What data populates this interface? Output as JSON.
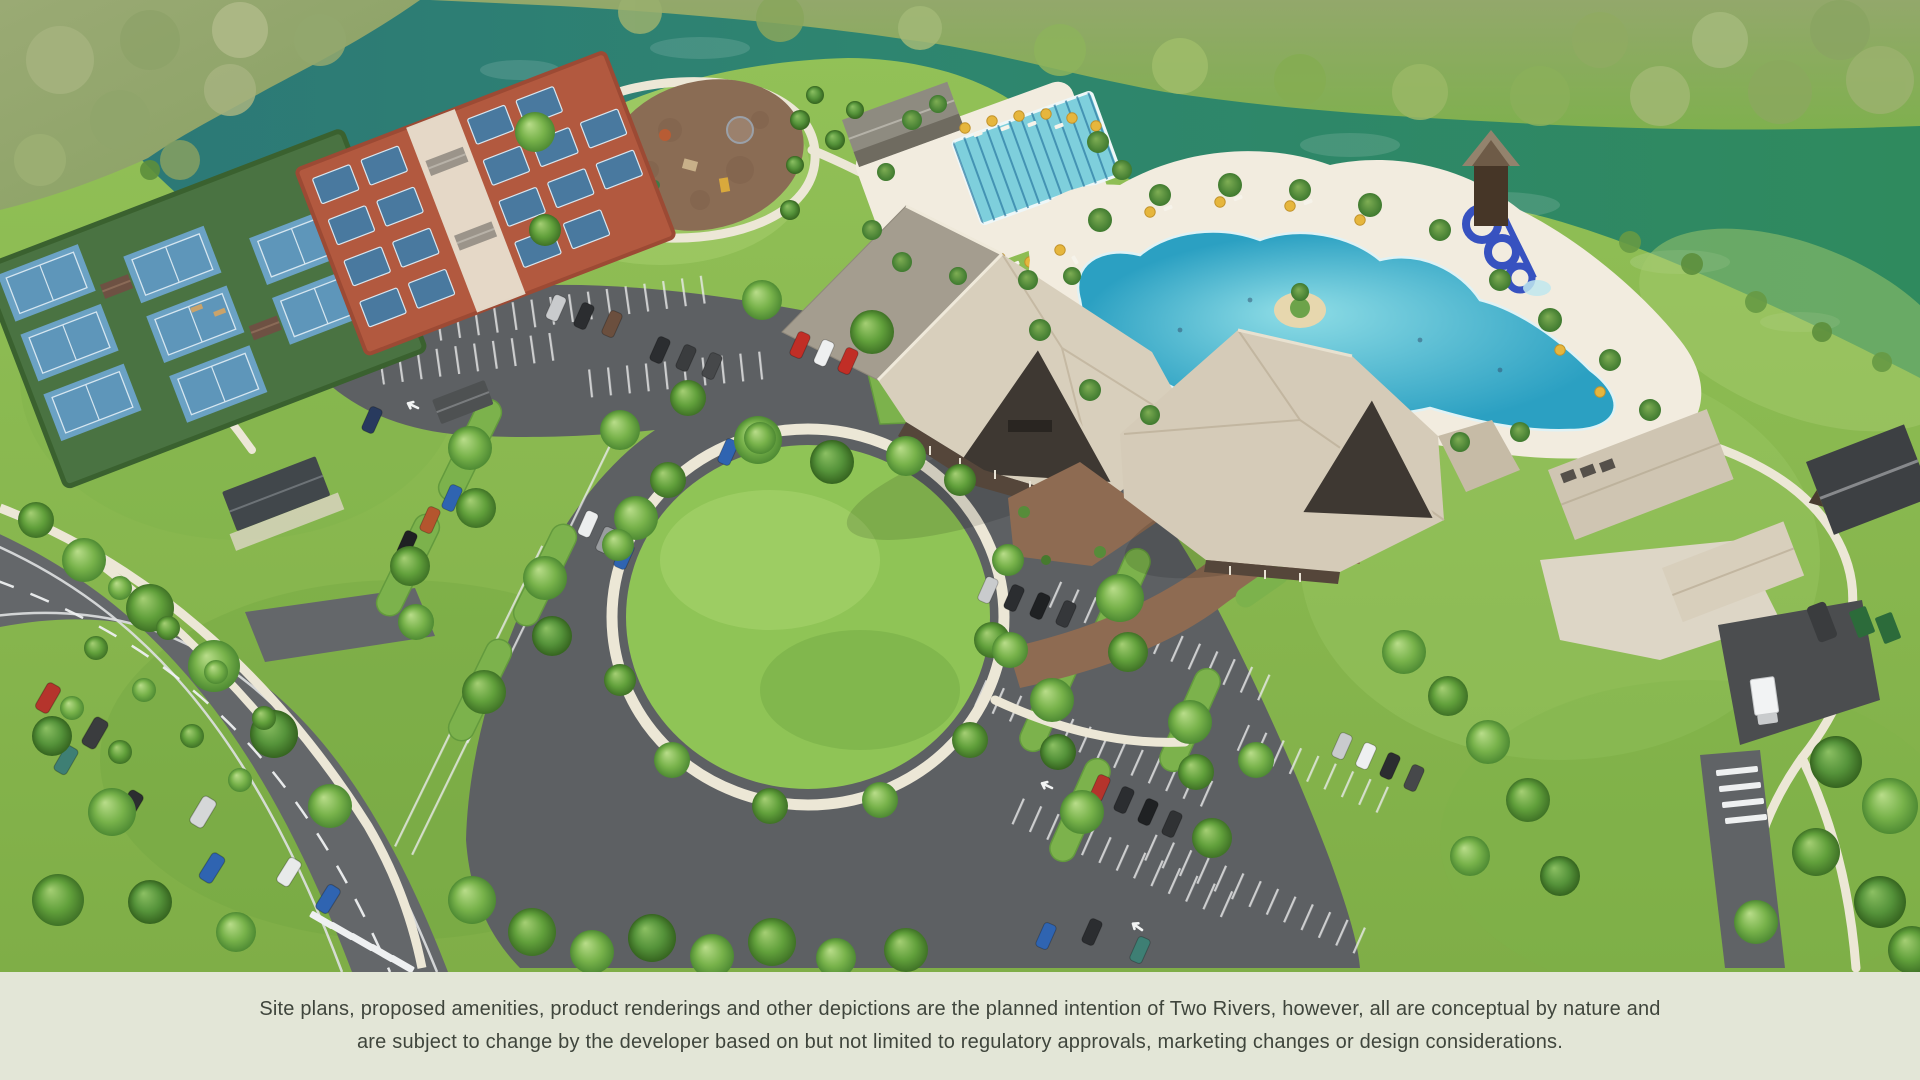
{
  "window": {
    "width": 1920,
    "height": 1080
  },
  "disclaimer": {
    "line1": "Site plans, proposed amenities, product renderings and other depictions are the planned intention of Two Rivers, however, all are conceptual by nature and",
    "line2": "are subject to change by the developer based on but not limited to regulatory approvals, marketing changes or design considerations."
  },
  "palette": {
    "footer_background": "#e3e6d7",
    "footer_text": "#3f453c",
    "river_teal": "#2c7678",
    "river_green": "#2f8a5e",
    "forest_sage": "#9aaa74",
    "lawn_green": "#8aba52",
    "asphalt": "#5d6063",
    "path_cream": "#ece7d6",
    "court_blue": "#5e96ba",
    "court_surround_green": "#4a7342",
    "pickleball_clay": "#b2593f",
    "pool_blue": "#45b6d3",
    "deck_cream": "#f2ecdf",
    "roof_tan": "#d8cfbc",
    "roof_dark": "#3e3832",
    "paver_brown": "#8e6b52",
    "umbrella_yellow": "#e6b63d",
    "tree_green": "#6faf4a"
  },
  "scene": {
    "type": "aerial-site-plan-rendering",
    "elements": [
      "river",
      "riverbank-forest",
      "tennis-courts",
      "pickleball-courts",
      "playground",
      "event-lawn",
      "lap-pool",
      "lagoon-pool",
      "water-slide-tower",
      "clubhouse",
      "fitness-building",
      "porte-cochere",
      "paver-drive",
      "parking-lots",
      "access-road",
      "vehicles",
      "service-yard",
      "walking-paths",
      "palm-trees",
      "shade-trees"
    ]
  }
}
